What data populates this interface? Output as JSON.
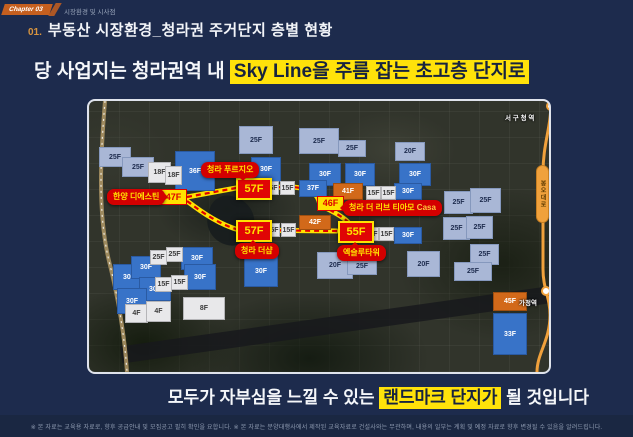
{
  "header": {
    "chapter_badge": "Chapter 03",
    "chapter_label": "시장환경 및 시사점",
    "section_no": "01.",
    "title": "부동산 시장환경_청라권 주거단지 층별 현황"
  },
  "headline": {
    "prefix": "당 사업지는 청라권역 내 ",
    "highlight": "Sky Line을 주름 잡는 초고층 단지로"
  },
  "footline": {
    "prefix": "모두가 자부심을 느낄 수 있는 ",
    "highlight": "랜드마크 단지가",
    "suffix": " 될 것입니다"
  },
  "colors": {
    "background": "#1d2b4d",
    "highlight_yellow": "#ffe20a",
    "landmark_red": "#e00505",
    "high_rise_blue": "#3873c8",
    "mid_rise_periwinkle": "#a9b7d6",
    "low_rise_white": "#e8e8ea",
    "tower_orange": "#d2691a",
    "transit_orange": "#f0a13c"
  },
  "map": {
    "road_label": {
      "text": "봉오대로"
    },
    "stations": [
      {
        "name": "서 구 청 역",
        "lx": 416,
        "ly": 11
      },
      {
        "name": "가정역",
        "lx": 430,
        "ly": 196
      }
    ],
    "labels": [
      {
        "text": "청라 푸르지오",
        "x": 112,
        "y": 61,
        "pointer": "bottom"
      },
      {
        "text": "한양 디에스틴",
        "x": 18,
        "y": 88,
        "pointer": "right"
      },
      {
        "text": "청라 더 리브 티아모",
        "accent": "Casa",
        "x": 254,
        "y": 99,
        "pointer": "left"
      },
      {
        "text": "청라 더샵",
        "x": 146,
        "y": 142,
        "pointer": "top"
      },
      {
        "text": "엑슬루타워",
        "x": 248,
        "y": 144,
        "pointer": "top"
      }
    ],
    "parcels": [
      {
        "t": "25F",
        "c": "lt",
        "x": 10,
        "y": 46,
        "w": 32,
        "h": 20
      },
      {
        "t": "25F",
        "c": "lt",
        "x": 33,
        "y": 56,
        "w": 32,
        "h": 20
      },
      {
        "t": "25F",
        "c": "lt",
        "x": 150,
        "y": 25,
        "w": 34,
        "h": 28
      },
      {
        "t": "25F",
        "c": "lt",
        "x": 210,
        "y": 27,
        "w": 40,
        "h": 26
      },
      {
        "t": "25F",
        "c": "lt",
        "x": 249,
        "y": 39,
        "w": 28,
        "h": 17
      },
      {
        "t": "20F",
        "c": "lt",
        "x": 306,
        "y": 41,
        "w": 30,
        "h": 19
      },
      {
        "t": "25F",
        "c": "lt",
        "x": 355,
        "y": 90,
        "w": 29,
        "h": 23
      },
      {
        "t": "25F",
        "c": "lt",
        "x": 381,
        "y": 87,
        "w": 31,
        "h": 25
      },
      {
        "t": "25F",
        "c": "lt",
        "x": 354,
        "y": 116,
        "w": 27,
        "h": 23
      },
      {
        "t": "25F",
        "c": "lt",
        "x": 377,
        "y": 115,
        "w": 27,
        "h": 23
      },
      {
        "t": "25F",
        "c": "lt",
        "x": 381,
        "y": 143,
        "w": 29,
        "h": 21
      },
      {
        "t": "25F",
        "c": "lt",
        "x": 365,
        "y": 161,
        "w": 38,
        "h": 19
      },
      {
        "t": "20F",
        "c": "lt",
        "x": 228,
        "y": 151,
        "w": 36,
        "h": 27
      },
      {
        "t": "20F",
        "c": "lt",
        "x": 318,
        "y": 150,
        "w": 33,
        "h": 26
      },
      {
        "t": "25F",
        "c": "lt",
        "x": 258,
        "y": 157,
        "w": 30,
        "h": 17
      },
      {
        "t": "36F",
        "c": "dk",
        "x": 86,
        "y": 50,
        "w": 40,
        "h": 40
      },
      {
        "t": "30F",
        "c": "dk",
        "x": 162,
        "y": 56,
        "w": 30,
        "h": 25
      },
      {
        "t": "30F",
        "c": "dk",
        "x": 220,
        "y": 62,
        "w": 32,
        "h": 23
      },
      {
        "t": "30F",
        "c": "dk",
        "x": 256,
        "y": 62,
        "w": 30,
        "h": 23
      },
      {
        "t": "30F",
        "c": "dk",
        "x": 310,
        "y": 62,
        "w": 32,
        "h": 23
      },
      {
        "t": "37F",
        "c": "dk",
        "x": 210,
        "y": 79,
        "w": 28,
        "h": 17
      },
      {
        "t": "30F",
        "c": "dk",
        "x": 305,
        "y": 82,
        "w": 28,
        "h": 17
      },
      {
        "t": "30F",
        "c": "dk",
        "x": 305,
        "y": 126,
        "w": 28,
        "h": 17
      },
      {
        "t": "30F",
        "c": "dk",
        "x": 155,
        "y": 154,
        "w": 34,
        "h": 32
      },
      {
        "t": "30F",
        "c": "dk",
        "x": 24,
        "y": 163,
        "w": 32,
        "h": 26
      },
      {
        "t": "30F",
        "c": "dk",
        "x": 42,
        "y": 155,
        "w": 30,
        "h": 23
      },
      {
        "t": "30F",
        "c": "dk",
        "x": 92,
        "y": 146,
        "w": 32,
        "h": 23
      },
      {
        "t": "30F",
        "c": "dk",
        "x": 95,
        "y": 163,
        "w": 32,
        "h": 26
      },
      {
        "t": "30F",
        "c": "dk",
        "x": 50,
        "y": 176,
        "w": 32,
        "h": 24
      },
      {
        "t": "30F",
        "c": "dk",
        "x": 28,
        "y": 187,
        "w": 30,
        "h": 26
      },
      {
        "t": "33F",
        "c": "dk",
        "x": 404,
        "y": 212,
        "w": 34,
        "h": 42
      },
      {
        "t": "18F",
        "c": "wh",
        "x": 59,
        "y": 61,
        "w": 23,
        "h": 21
      },
      {
        "t": "18F",
        "c": "wh",
        "x": 76,
        "y": 65,
        "w": 17,
        "h": 19
      },
      {
        "t": "15F",
        "c": "wh",
        "x": 175,
        "y": 80,
        "w": 15,
        "h": 14
      },
      {
        "t": "15F",
        "c": "wh",
        "x": 191,
        "y": 80,
        "w": 15,
        "h": 14
      },
      {
        "t": "15F",
        "c": "wh",
        "x": 277,
        "y": 85,
        "w": 15,
        "h": 14
      },
      {
        "t": "15F",
        "c": "wh",
        "x": 292,
        "y": 85,
        "w": 15,
        "h": 14
      },
      {
        "t": "15F",
        "c": "wh",
        "x": 176,
        "y": 122,
        "w": 15,
        "h": 14
      },
      {
        "t": "15F",
        "c": "wh",
        "x": 192,
        "y": 122,
        "w": 15,
        "h": 14
      },
      {
        "t": "15F",
        "c": "wh",
        "x": 275,
        "y": 126,
        "w": 15,
        "h": 14
      },
      {
        "t": "15F",
        "c": "wh",
        "x": 290,
        "y": 126,
        "w": 15,
        "h": 14
      },
      {
        "t": "25F",
        "c": "wh",
        "x": 61,
        "y": 149,
        "w": 17,
        "h": 15
      },
      {
        "t": "25F",
        "c": "wh",
        "x": 77,
        "y": 146,
        "w": 17,
        "h": 15
      },
      {
        "t": "15F",
        "c": "wh",
        "x": 66,
        "y": 176,
        "w": 17,
        "h": 15
      },
      {
        "t": "15F",
        "c": "wh",
        "x": 82,
        "y": 174,
        "w": 17,
        "h": 15
      },
      {
        "t": "4F",
        "c": "wh",
        "x": 36,
        "y": 203,
        "w": 23,
        "h": 19
      },
      {
        "t": "4F",
        "c": "wh",
        "x": 57,
        "y": 200,
        "w": 25,
        "h": 21
      },
      {
        "t": "8F",
        "c": "wh",
        "x": 94,
        "y": 196,
        "w": 42,
        "h": 23
      },
      {
        "t": "41F",
        "c": "or",
        "x": 244,
        "y": 82,
        "w": 30,
        "h": 17
      },
      {
        "t": "42F",
        "c": "or",
        "x": 210,
        "y": 114,
        "w": 32,
        "h": 15
      },
      {
        "t": "45F",
        "c": "or",
        "x": 404,
        "y": 191,
        "w": 34,
        "h": 19
      },
      {
        "t": "57F",
        "c": "rd",
        "x": 147,
        "y": 77,
        "w": 36,
        "h": 22
      },
      {
        "t": "57F",
        "c": "rd",
        "x": 147,
        "y": 119,
        "w": 36,
        "h": 22
      },
      {
        "t": "55F",
        "c": "rd",
        "x": 249,
        "y": 120,
        "w": 36,
        "h": 22
      },
      {
        "t": "47F",
        "c": "yl",
        "x": 71,
        "y": 88,
        "w": 27,
        "h": 16
      },
      {
        "t": "46F",
        "c": "yl",
        "x": 228,
        "y": 95,
        "w": 27,
        "h": 15
      }
    ]
  },
  "footer": {
    "disclaimer": "※ 본 자료는 교육용 자료로, 향후 공급안내 및 모집공고 필히 확인을 요합니다. ※ 본 자료는 분양대행사에서 제작된 교육자료로 건설사와는 무관하며, 내용의 일부는 계획 및 예정 자료로 향후 변경될 수 있음을 알려드립니다."
  }
}
